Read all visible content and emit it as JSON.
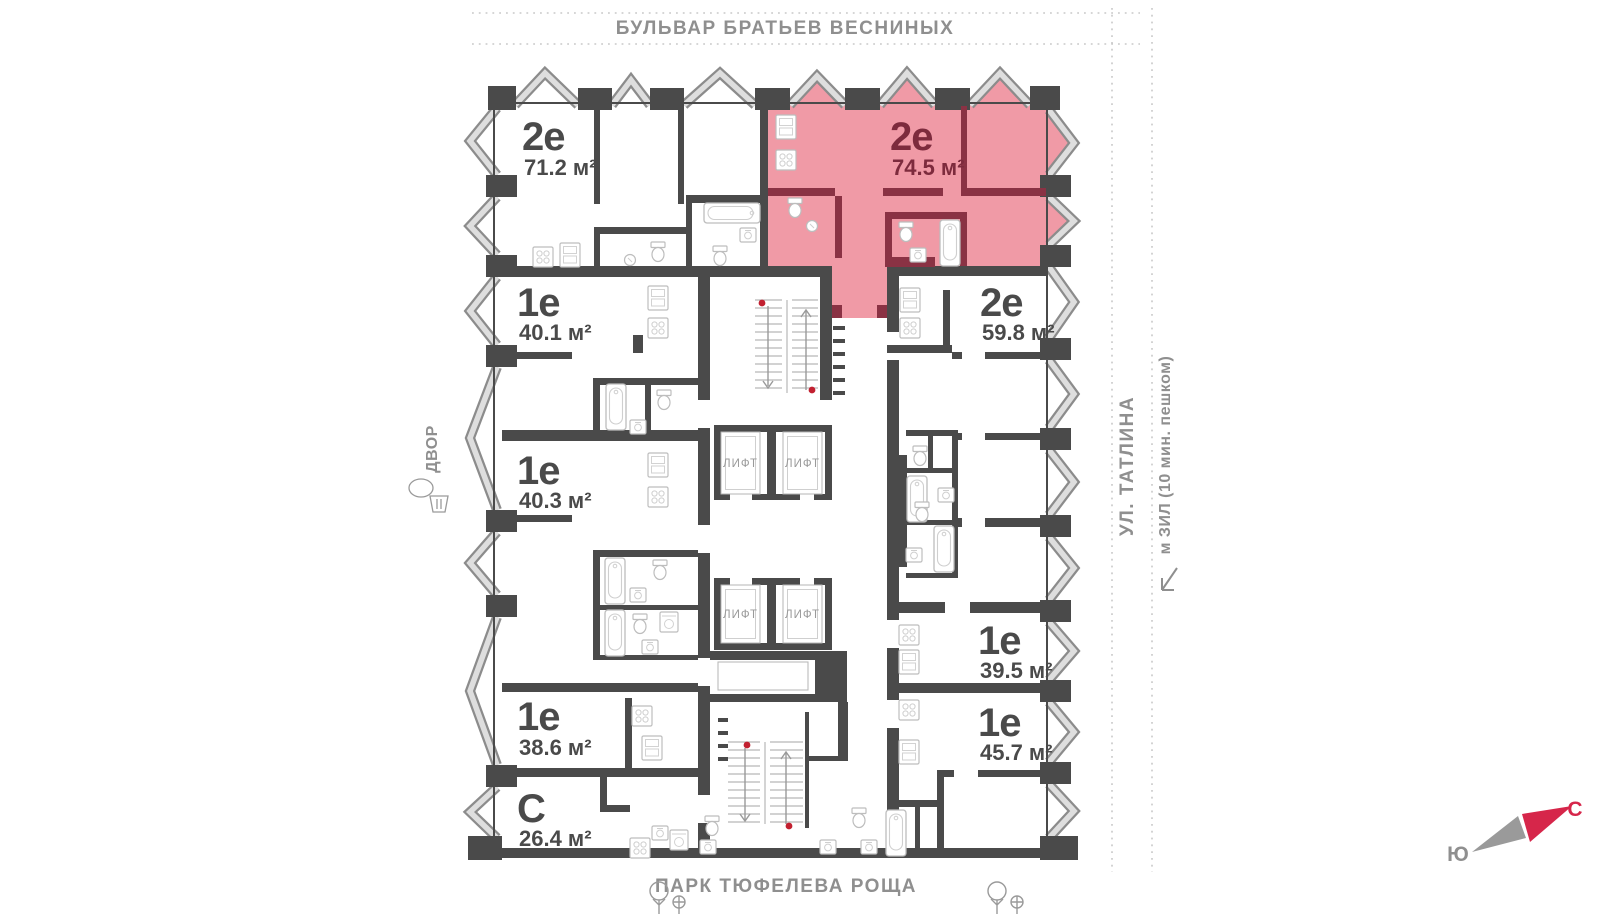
{
  "surroundings": {
    "top_street": "БУЛЬВАР БРАТЬЕВ ВЕСНИНЫХ",
    "right_street": "УЛ. ТАТЛИНА",
    "right_metro": "м ЗИЛ (10 мин. пешком)",
    "bottom_park": "ПАРК ТЮФЕЛЕВА РОЩА",
    "left_area": "ДВОР"
  },
  "compass": {
    "north": "С",
    "south": "Ю"
  },
  "core": {
    "lift_label": "ЛИФТ"
  },
  "apartments": [
    {
      "type": "2е",
      "area": "71.2 м²",
      "selected": false
    },
    {
      "type": "2е",
      "area": "74.5 м²",
      "selected": true
    },
    {
      "type": "2е",
      "area": "59.8 м²",
      "selected": false
    },
    {
      "type": "1е",
      "area": "40.1 м²",
      "selected": false
    },
    {
      "type": "1е",
      "area": "40.3 м²",
      "selected": false
    },
    {
      "type": "1е",
      "area": "38.6 м²",
      "selected": false
    },
    {
      "type": "С",
      "area": "26.4 м²",
      "selected": false
    },
    {
      "type": "1е",
      "area": "39.5 м²",
      "selected": false
    },
    {
      "type": "1е",
      "area": "45.7 м²",
      "selected": false
    }
  ],
  "colors": {
    "highlight_fill": "#f09aa6",
    "highlight_wall": "#8a3244",
    "highlight_text": "#7d2b3d",
    "wall": "#4a4a4a",
    "street_text": "#8f8f8f",
    "north_letter": "#d6264a",
    "red_dot": "#c22030"
  }
}
